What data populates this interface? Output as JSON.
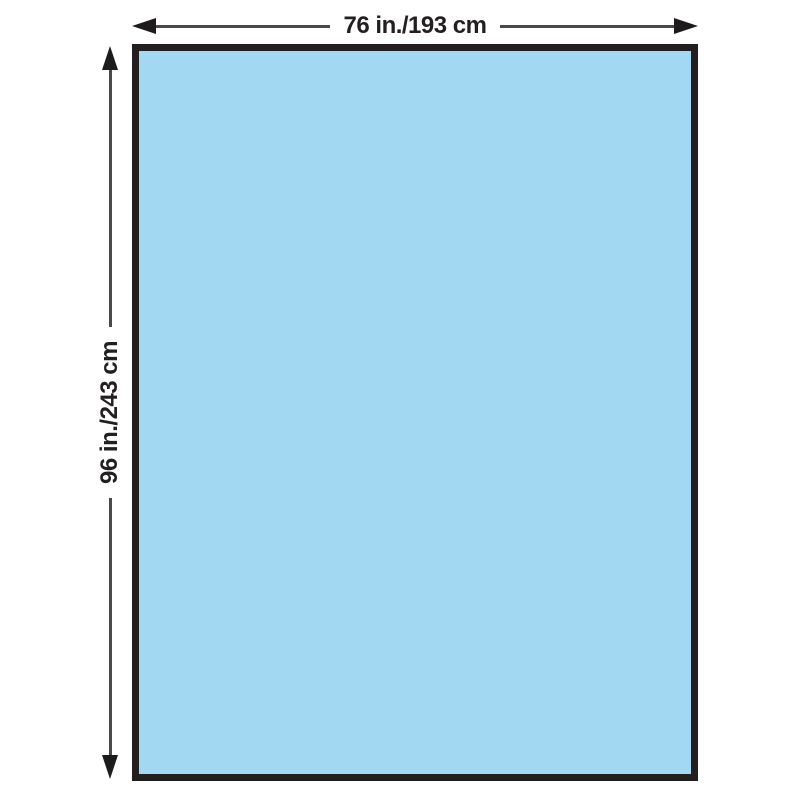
{
  "diagram": {
    "type": "product-dimension-diagram",
    "shape": "rectangle",
    "width_label": "76 in./193 cm",
    "height_label": "96 in./243 cm"
  },
  "icons": {
    "arrow_left": "css-triangle-left",
    "arrow_right": "css-triangle-right",
    "arrow_up": "css-triangle-up",
    "arrow_down": "css-triangle-down"
  },
  "colors": {
    "background": "#ffffff",
    "drape_fill": "#a3d8f2",
    "drape_border": "#231f20",
    "dimension_line": "#4a4a4a",
    "arrowhead": "#1d1b1c",
    "text": "#231f20"
  }
}
